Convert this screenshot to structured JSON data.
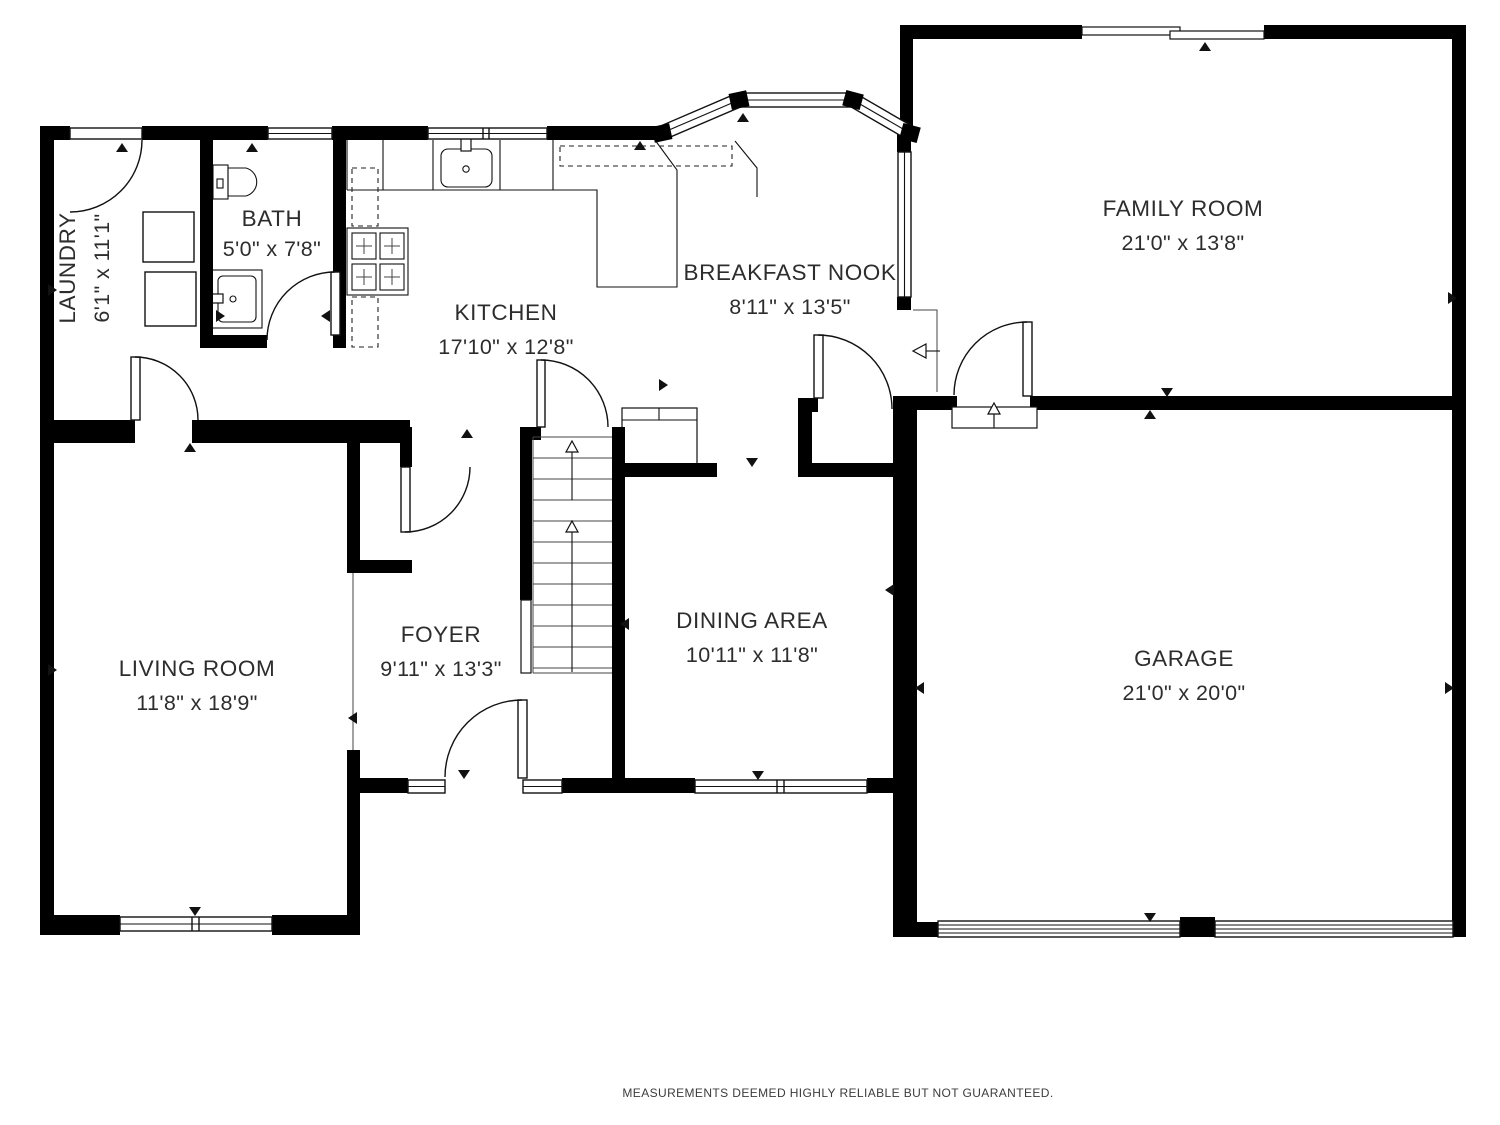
{
  "rooms": {
    "laundry": {
      "name": "LAUNDRY",
      "dims": "6'1\" x 11'1\""
    },
    "bath": {
      "name": "BATH",
      "dims": "5'0\" x 7'8\""
    },
    "kitchen": {
      "name": "KITCHEN",
      "dims": "17'10\" x 12'8\""
    },
    "breakfast_nook": {
      "name": "BREAKFAST NOOK",
      "dims": "8'11\" x 13'5\""
    },
    "family_room": {
      "name": "FAMILY ROOM",
      "dims": "21'0\" x 13'8\""
    },
    "living_room": {
      "name": "LIVING ROOM",
      "dims": "11'8\" x 18'9\""
    },
    "foyer": {
      "name": "FOYER",
      "dims": "9'11\" x 13'3\""
    },
    "dining_area": {
      "name": "DINING AREA",
      "dims": "10'11\" x 11'8\""
    },
    "garage": {
      "name": "GARAGE",
      "dims": "21'0\" x 20'0\""
    }
  },
  "footer": {
    "disclaimer": "MEASUREMENTS DEEMED HIGHLY RELIABLE BUT NOT GUARANTEED."
  },
  "colors": {
    "wall": "#000000",
    "background": "#ffffff",
    "text": "#2d2d2d"
  }
}
